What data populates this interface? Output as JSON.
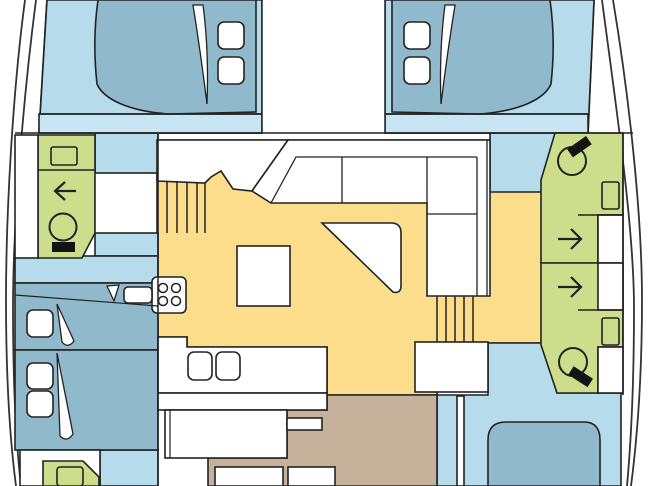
{
  "diagram": {
    "type": "floorplan",
    "subject": "catamaran-interior-deck-plan",
    "colors": {
      "background": "#FFFFFF",
      "outline": "#222222",
      "hull_outline": "#333333",
      "floor": "#B6DCEC",
      "floor_light": "#C7E5F2",
      "bed": "#90BACC",
      "wet_room": "#CCDE8B",
      "salon": "#FBDD8C",
      "cockpit": "#C6B29B",
      "fixture_white": "#FFFFFF",
      "toilet_seat": "#141414"
    },
    "rooms": {
      "cabins": [
        "bow-cabin-port",
        "bow-cabin-starboard",
        "mid-cabin-port",
        "aft-cabin-port",
        "aft-cabin-starboard"
      ],
      "wet_rooms": [
        "head-forward-port",
        "head-aft-port",
        "head-forward-starboard",
        "head-aft-starboard"
      ],
      "salon": [
        "l-settee",
        "cocktail-table",
        "dinette-table",
        "chart-seat"
      ],
      "galley": [
        "stove-four-burner",
        "double-sink"
      ],
      "circulation": [
        "companionway-stairs-port",
        "companionway-stairs-starboard",
        "cockpit-walkway"
      ],
      "cockpit": [
        "bench-seat",
        "stool-left",
        "stool-right"
      ]
    },
    "icons": {
      "toilet": "circle-with-black-seat",
      "sink": "rounded-rectangle",
      "shower": "direction-arrow",
      "stove": "four-burner-circles",
      "pillow": "rounded-square",
      "sheet_fold": "white-sliver"
    }
  }
}
